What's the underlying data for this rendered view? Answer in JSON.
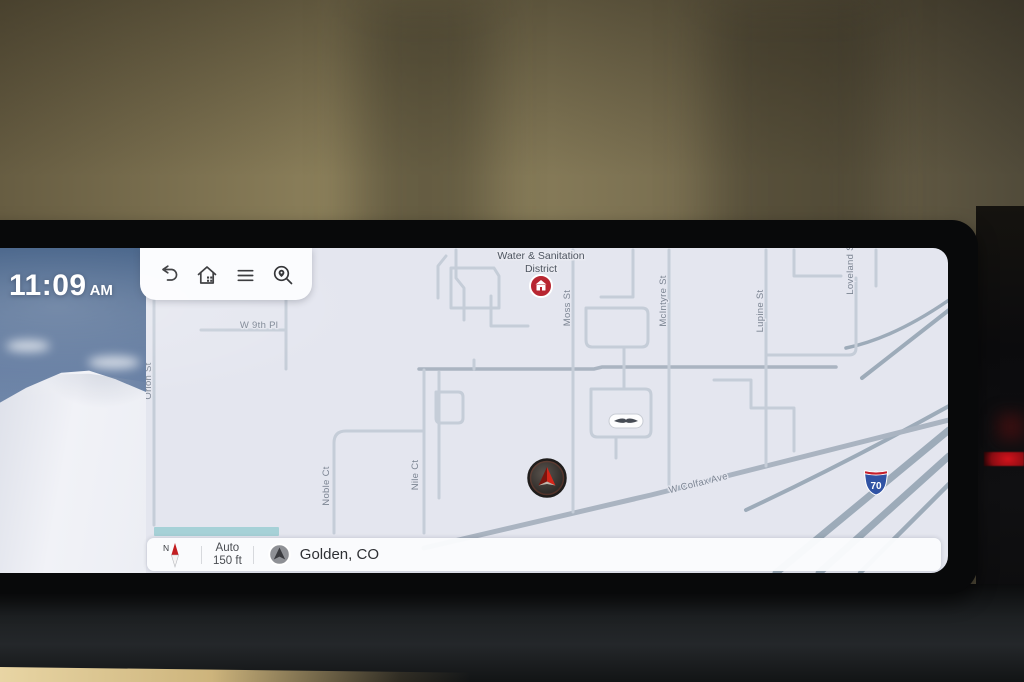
{
  "clock": {
    "time": "11:09",
    "meridiem": "AM"
  },
  "toolbar": {
    "buttons": [
      {
        "id": "back",
        "icon": "undo-arrow-icon"
      },
      {
        "id": "home",
        "icon": "home-icon"
      },
      {
        "id": "menu",
        "icon": "hamburger-menu-icon"
      },
      {
        "id": "search",
        "icon": "map-search-icon"
      }
    ]
  },
  "map": {
    "street_labels": [
      {
        "name": "Orion St",
        "x": 5,
        "y": 133,
        "rot": -90
      },
      {
        "name": "W 9th Pl",
        "x": 113,
        "y": 80,
        "rot": 0
      },
      {
        "name": "Moss St",
        "x": 424,
        "y": 60,
        "rot": -90
      },
      {
        "name": "McIntyre St",
        "x": 520,
        "y": 53,
        "rot": -90
      },
      {
        "name": "Lupine St",
        "x": 617,
        "y": 63,
        "rot": -90
      },
      {
        "name": "Loveland St",
        "x": 707,
        "y": 20,
        "rot": -90
      },
      {
        "name": "Nile Ct",
        "x": 272,
        "y": 227,
        "rot": -90
      },
      {
        "name": "Noble Ct",
        "x": 183,
        "y": 238,
        "rot": -90
      },
      {
        "name": "W Colfax Ave",
        "x": 553,
        "y": 238,
        "rot": -14
      }
    ],
    "poi_water_district": {
      "label_line1": "Water & Sanitation",
      "label_line2": "District"
    },
    "highway_shield": {
      "number": "70"
    }
  },
  "status_bar": {
    "compass_label": "N",
    "zoom_mode": "Auto",
    "zoom_scale": "150 ft",
    "current_location": "Golden, CO"
  },
  "colors": {
    "map_bg": "#e4e6ef",
    "poi_red": "#b82631",
    "shield_blue": "#3053a4",
    "shield_red": "#c51f2b",
    "accent_teal": "#7fc4c8",
    "marker_red": "#d4261a",
    "ambient_red": "#c01018"
  }
}
